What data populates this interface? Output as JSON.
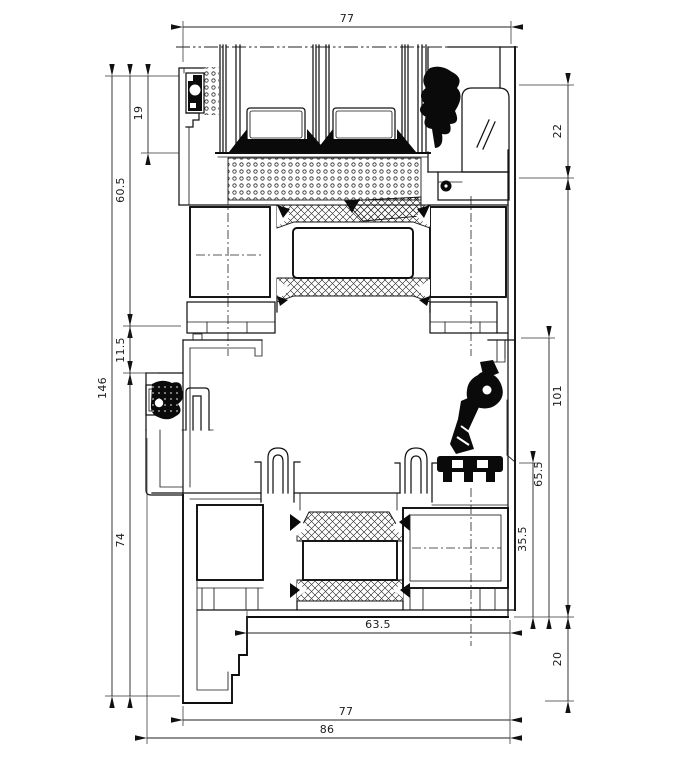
{
  "dimensions": {
    "top_width": "77",
    "glazing_rebate": "19",
    "upper_sash_height": "60.5",
    "overall_height": "146",
    "center_gap": "11.5",
    "lower_section_height": "74",
    "head_height": "22",
    "frame_inner_height": "101",
    "lower_sash_height": "65.5",
    "lower_chamber_height": "35.5",
    "sill_depth": "20",
    "sill_inner_width": "63.5",
    "bottom_width": "77",
    "overall_width": "86"
  }
}
